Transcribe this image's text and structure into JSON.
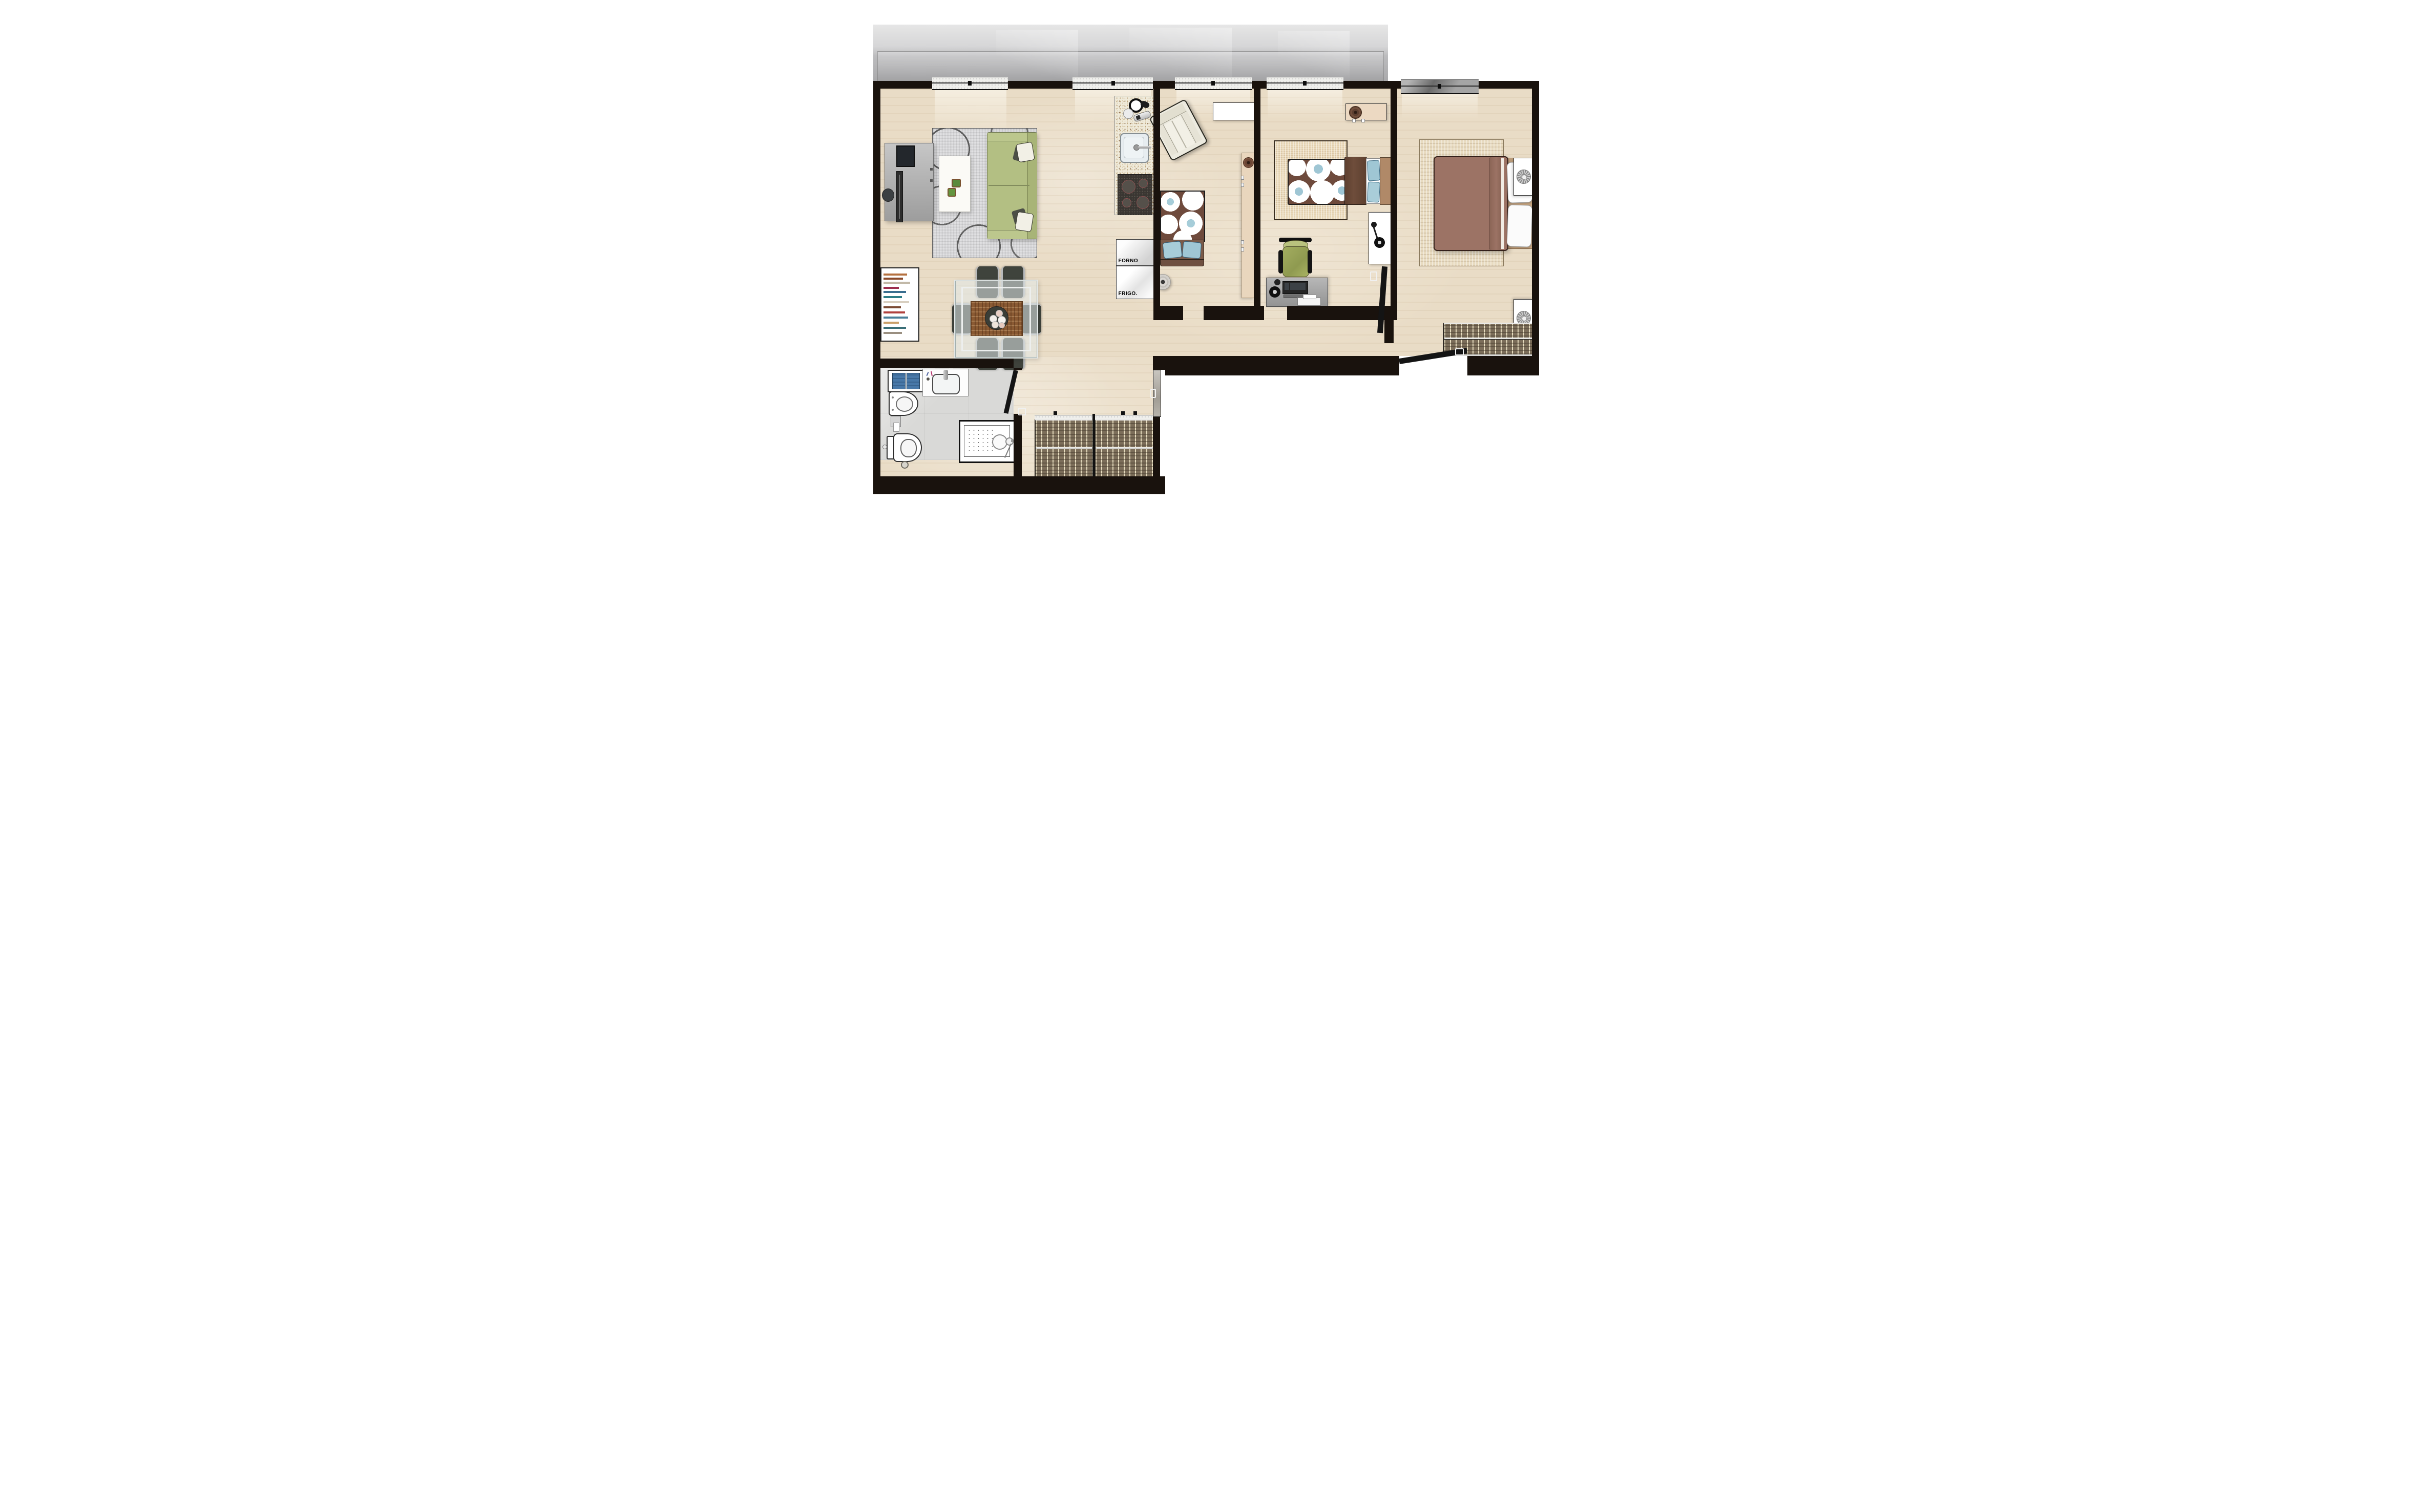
{
  "labels": {
    "oven": "FORNO",
    "fridge": "FRIGO."
  },
  "palette": {
    "wall": "#19120d",
    "floor_wood": "#e9dcc6",
    "floor_bathroom": "#d9d9d7",
    "terrace_gray": "#b9b9bb",
    "sofa_green": "#b3bf83",
    "fabric_brown": "#6e4a3c",
    "fabric_blue": "#9fc6d4",
    "duvet_brown": "#9c7365",
    "towel_blue": "#4878a8",
    "rug_living_gray": "#e0e0e2",
    "rug_beige": "#ead9b9",
    "granite_counter": "#efeada",
    "desk_gray": "#a8a8a8",
    "dining_chair_dark": "#3f433c"
  },
  "rooms": [
    {
      "name": "living-dining-room"
    },
    {
      "name": "kitchen"
    },
    {
      "name": "bedroom-1"
    },
    {
      "name": "bedroom-2"
    },
    {
      "name": "master-bedroom"
    },
    {
      "name": "bathroom"
    },
    {
      "name": "hallway"
    },
    {
      "name": "corridor"
    },
    {
      "name": "terrace"
    }
  ]
}
